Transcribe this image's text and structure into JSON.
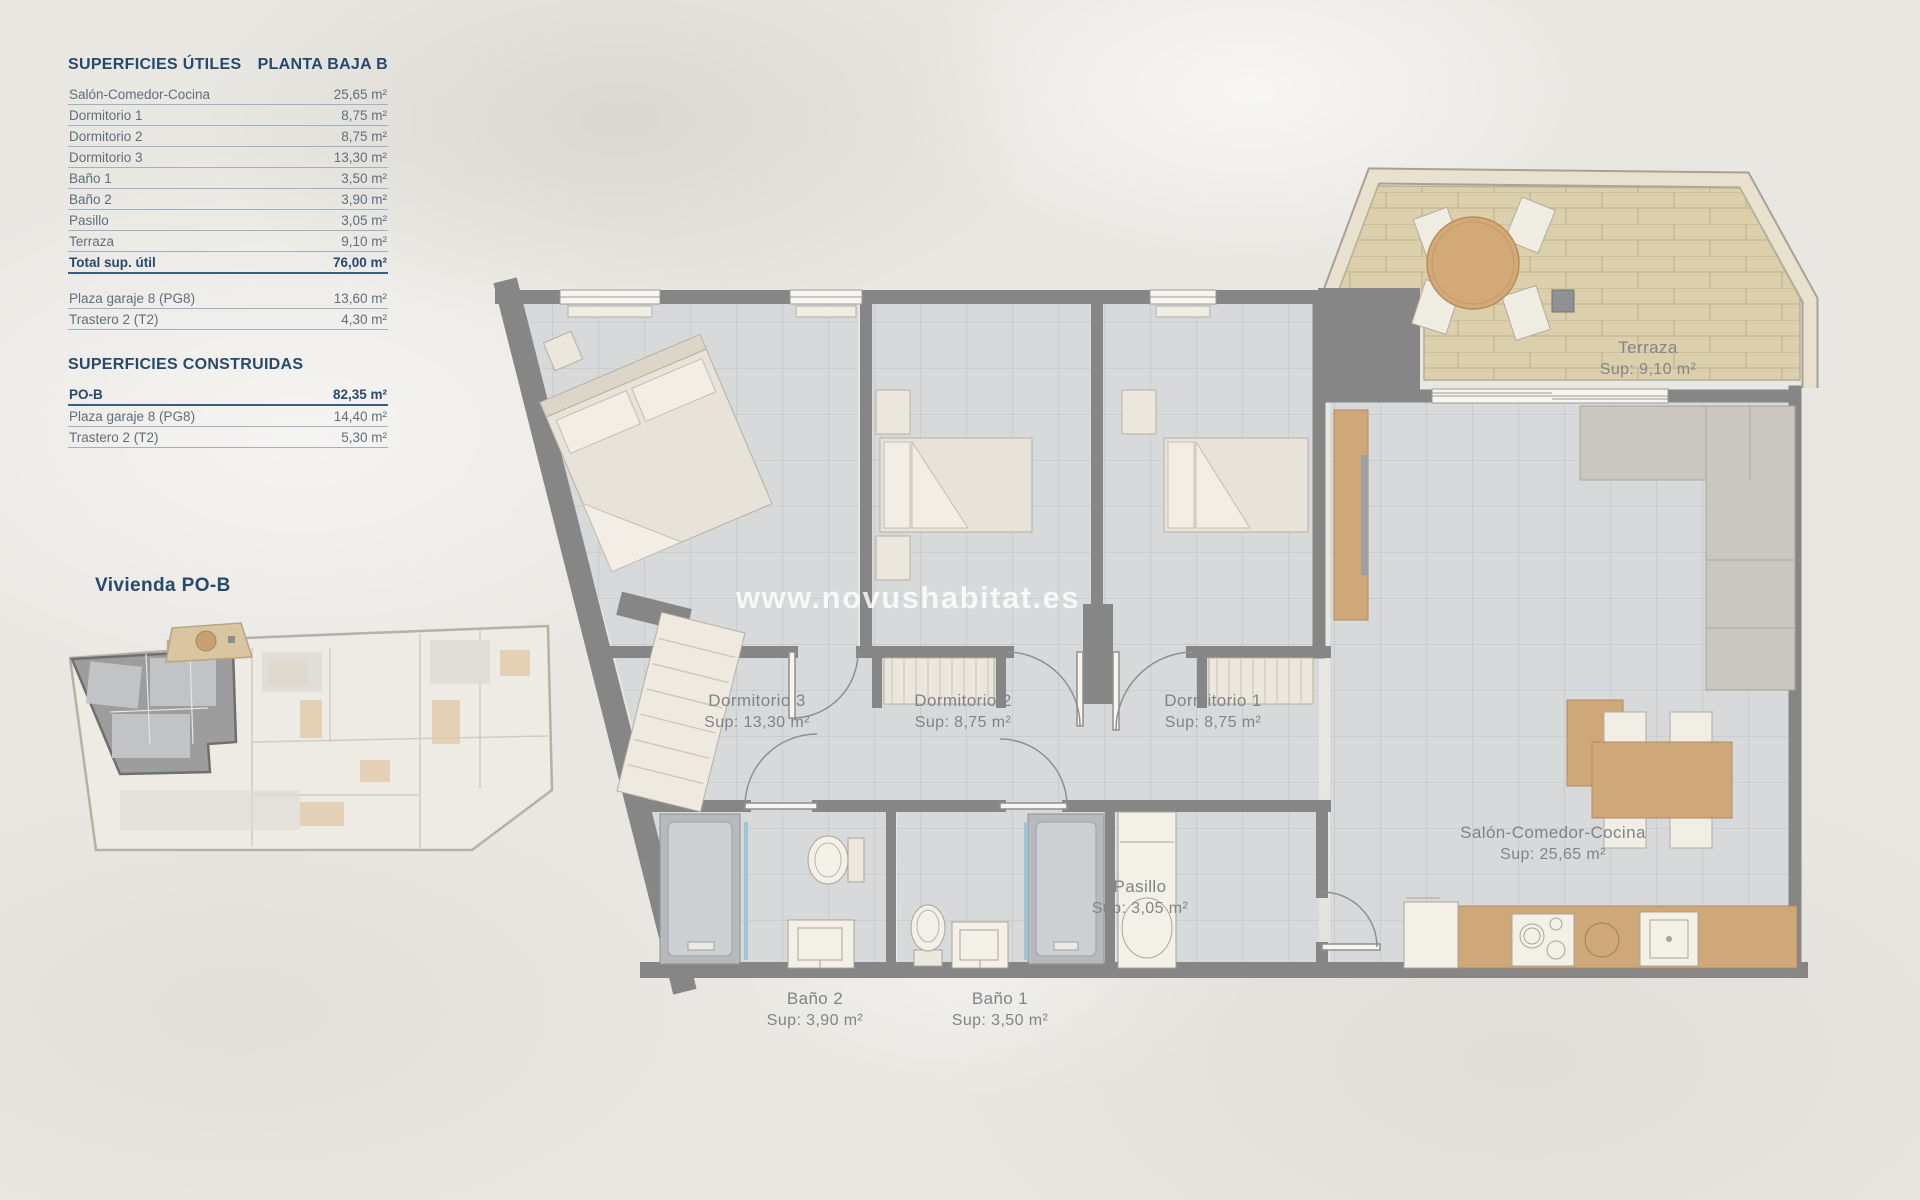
{
  "tables": {
    "utiles": {
      "title": "SUPERFICIES ÚTILES",
      "subtitle": "PLANTA BAJA B",
      "rows": [
        {
          "label": "Salón-Comedor-Cocina",
          "value": "25,65 m²"
        },
        {
          "label": "Dormitorio 1",
          "value": "8,75 m²"
        },
        {
          "label": "Dormitorio 2",
          "value": "8,75 m²"
        },
        {
          "label": "Dormitorio 3",
          "value": "13,30 m²"
        },
        {
          "label": "Baño 1",
          "value": "3,50 m²"
        },
        {
          "label": "Baño 2",
          "value": "3,90 m²"
        },
        {
          "label": "Pasillo",
          "value": "3,05 m²"
        },
        {
          "label": "Terraza",
          "value": "9,10 m²"
        },
        {
          "label": "Total sup. útil",
          "value": "76,00 m²"
        }
      ],
      "extra_rows": [
        {
          "label": "Plaza garaje 8 (PG8)",
          "value": "13,60 m²"
        },
        {
          "label": "Trastero 2 (T2)",
          "value": "4,30 m²"
        }
      ]
    },
    "construidas": {
      "title": "SUPERFICIES CONSTRUIDAS",
      "rows": [
        {
          "label": "PO-B",
          "value": "82,35 m²"
        },
        {
          "label": "Plaza garaje 8 (PG8)",
          "value": "14,40 m²"
        },
        {
          "label": "Trastero 2 (T2)",
          "value": "5,30 m²"
        }
      ]
    }
  },
  "miniplan": {
    "label": "Vivienda PO-B"
  },
  "plan": {
    "watermark": "www.novushabitat.es",
    "rooms": {
      "terraza": {
        "name": "Terraza",
        "sup": "Sup: 9,10 m²"
      },
      "dorm3": {
        "name": "Dormitorio 3",
        "sup": "Sup: 13,30 m²"
      },
      "dorm2": {
        "name": "Dormitorio 2",
        "sup": "Sup: 8,75 m²"
      },
      "dorm1": {
        "name": "Dormitorio 1",
        "sup": "Sup: 8,75 m²"
      },
      "salon": {
        "name": "Salón-Comedor-Cocina",
        "sup": "Sup: 25,65 m²"
      },
      "pasillo": {
        "name": "Pasillo",
        "sup": "Sup: 3,05 m²"
      },
      "bano2": {
        "name": "Baño 2",
        "sup": "Sup: 3,90 m²"
      },
      "bano1": {
        "name": "Baño 1",
        "sup": "Sup: 3,50 m²"
      }
    }
  },
  "colors": {
    "navy": "#27496e",
    "row_text": "#5f6e7d",
    "wall": "#868686",
    "wood": "#cfa87a",
    "terraza_floor": "#dccfab",
    "tile_floor": "#d8d9da"
  }
}
